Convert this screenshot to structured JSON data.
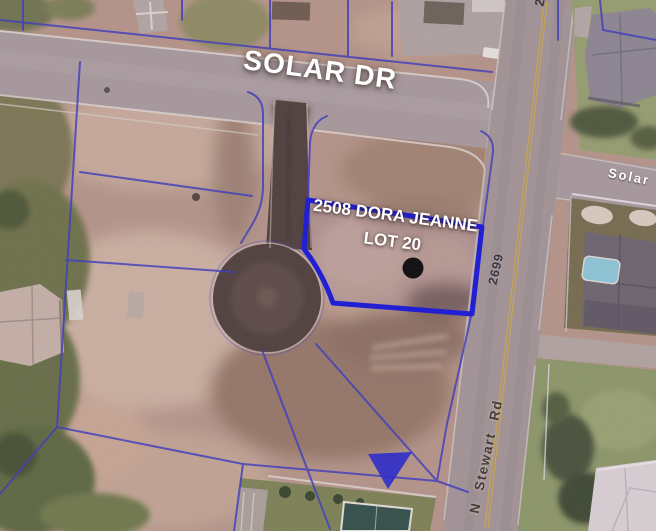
{
  "image_type": "satellite-aerial-parcel-view",
  "labels": {
    "street_main": "SOLAR DR",
    "parcel_line1": "2508 DORA JEANNE",
    "parcel_line2": "LOT 20",
    "street_side": "Solar",
    "parcel_number": "2699",
    "street_cross": "N Stewart Rd",
    "partial_number": "2"
  },
  "markers": {
    "parcel_dot": "black-location-dot",
    "survey_wedge": "blue-filled-triangle"
  },
  "colors": {
    "parcel_boundary_thin": "#3a3ac0",
    "parcel_boundary_highlight": "#1717d9",
    "marker_dot": "#0a0a0a",
    "road_pavement": "#a89b9d",
    "asphalt_dark": "#4e3f3b",
    "dirt_ground": "#b69789",
    "lawn_green": "#8d9968",
    "pool_water": "#8ccad8",
    "label_text": "#ffffff"
  }
}
